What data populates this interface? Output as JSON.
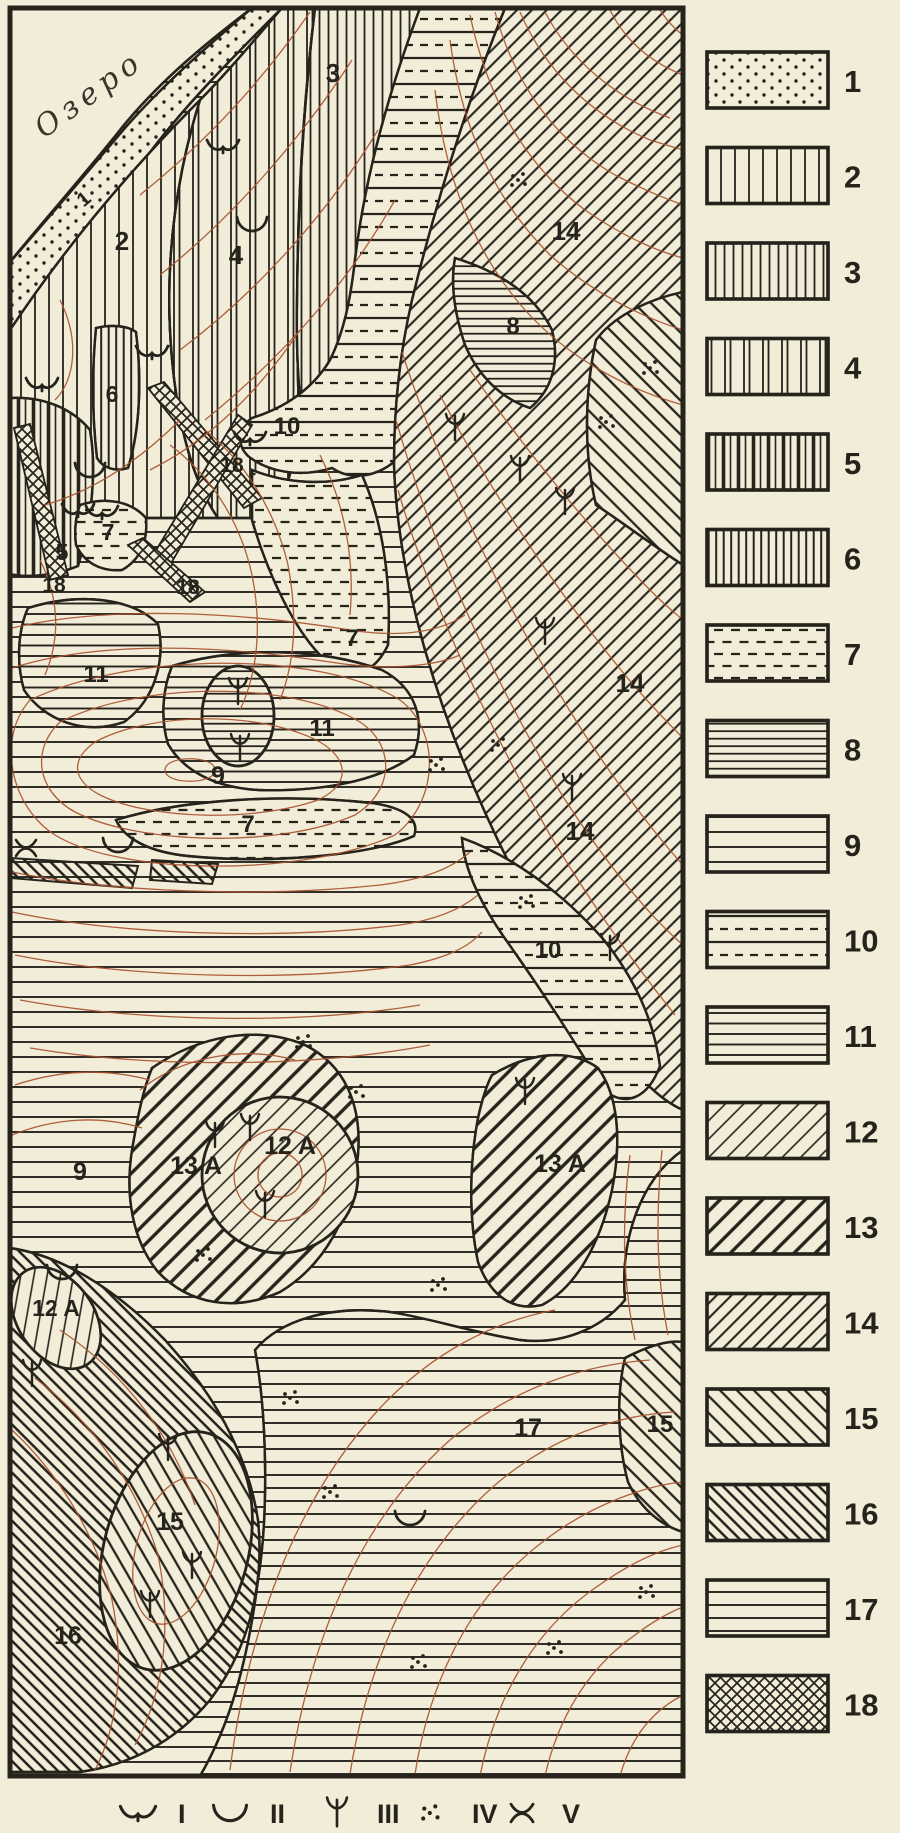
{
  "colors": {
    "paper": "#f2edd8",
    "ink": "#26231c",
    "contour_line": "#a8512f"
  },
  "map": {
    "lake_label": "Озеро",
    "labels": [
      {
        "t": "1",
        "x": 88,
        "y": 204,
        "r": -40,
        "fs": 20
      },
      {
        "t": "2",
        "x": 122,
        "y": 250,
        "fs": 26
      },
      {
        "t": "3",
        "x": 333,
        "y": 82,
        "fs": 26
      },
      {
        "t": "4",
        "x": 236,
        "y": 264,
        "fs": 26
      },
      {
        "t": "14",
        "x": 566,
        "y": 240,
        "fs": 26
      },
      {
        "t": "8",
        "x": 513,
        "y": 334,
        "fs": 24
      },
      {
        "t": "10",
        "x": 287,
        "y": 434,
        "fs": 24
      },
      {
        "t": "6",
        "x": 112,
        "y": 402,
        "fs": 23
      },
      {
        "t": "18",
        "x": 232,
        "y": 472,
        "fs": 21
      },
      {
        "t": "5",
        "x": 62,
        "y": 560,
        "fs": 23
      },
      {
        "t": "7",
        "x": 108,
        "y": 540,
        "fs": 23
      },
      {
        "t": "18",
        "x": 54,
        "y": 592,
        "fs": 21
      },
      {
        "t": "18",
        "x": 188,
        "y": 594,
        "fs": 21
      },
      {
        "t": "7",
        "x": 352,
        "y": 646,
        "fs": 24
      },
      {
        "t": "14",
        "x": 630,
        "y": 692,
        "fs": 26
      },
      {
        "t": "11",
        "x": 96,
        "y": 682,
        "fs": 24
      },
      {
        "t": "11",
        "x": 322,
        "y": 736,
        "fs": 24
      },
      {
        "t": "14",
        "x": 580,
        "y": 840,
        "fs": 26
      },
      {
        "t": "9",
        "x": 218,
        "y": 784,
        "fs": 25
      },
      {
        "t": "7",
        "x": 248,
        "y": 832,
        "fs": 24
      },
      {
        "t": "10",
        "x": 548,
        "y": 958,
        "fs": 24
      },
      {
        "t": "9",
        "x": 80,
        "y": 1180,
        "fs": 25
      },
      {
        "t": "12 A",
        "x": 290,
        "y": 1154,
        "fs": 25
      },
      {
        "t": "13 A",
        "x": 196,
        "y": 1174,
        "fs": 25
      },
      {
        "t": "13 A",
        "x": 560,
        "y": 1172,
        "fs": 25
      },
      {
        "t": "12 A",
        "x": 56,
        "y": 1316,
        "fs": 23
      },
      {
        "t": "15",
        "x": 660,
        "y": 1432,
        "fs": 24
      },
      {
        "t": "17",
        "x": 528,
        "y": 1436,
        "fs": 25
      },
      {
        "t": "15",
        "x": 170,
        "y": 1530,
        "fs": 25
      },
      {
        "t": "16",
        "x": 68,
        "y": 1644,
        "fs": 25
      }
    ],
    "symbols": [
      {
        "t": "I",
        "x": 223,
        "y": 146
      },
      {
        "t": "II",
        "x": 252,
        "y": 224
      },
      {
        "t": "I",
        "x": 152,
        "y": 352
      },
      {
        "t": "I",
        "x": 42,
        "y": 384
      },
      {
        "t": "II",
        "x": 90,
        "y": 470
      },
      {
        "t": "I",
        "x": 250,
        "y": 438
      },
      {
        "t": "I",
        "x": 78,
        "y": 510
      },
      {
        "t": "I",
        "x": 102,
        "y": 512
      },
      {
        "t": "III",
        "x": 238,
        "y": 692
      },
      {
        "t": "III",
        "x": 240,
        "y": 748
      },
      {
        "t": "II",
        "x": 118,
        "y": 845
      },
      {
        "t": "V",
        "x": 26,
        "y": 848
      },
      {
        "t": "III",
        "x": 455,
        "y": 428
      },
      {
        "t": "III",
        "x": 565,
        "y": 502
      },
      {
        "t": "III",
        "x": 520,
        "y": 470
      },
      {
        "t": "III",
        "x": 545,
        "y": 632
      },
      {
        "t": "III",
        "x": 572,
        "y": 788
      },
      {
        "t": "III",
        "x": 610,
        "y": 948
      },
      {
        "t": "IV",
        "x": 520,
        "y": 180
      },
      {
        "t": "IV",
        "x": 652,
        "y": 368
      },
      {
        "t": "IV",
        "x": 608,
        "y": 422
      },
      {
        "t": "IV",
        "x": 500,
        "y": 745
      },
      {
        "t": "IV",
        "x": 438,
        "y": 765
      },
      {
        "t": "IV",
        "x": 528,
        "y": 902
      },
      {
        "t": "IV",
        "x": 305,
        "y": 1042
      },
      {
        "t": "IV",
        "x": 358,
        "y": 1092
      },
      {
        "t": "III",
        "x": 525,
        "y": 1092
      },
      {
        "t": "III",
        "x": 250,
        "y": 1128
      },
      {
        "t": "III",
        "x": 215,
        "y": 1135
      },
      {
        "t": "III",
        "x": 265,
        "y": 1205
      },
      {
        "t": "IV",
        "x": 205,
        "y": 1255
      },
      {
        "t": "IV",
        "x": 440,
        "y": 1285
      },
      {
        "t": "II",
        "x": 62,
        "y": 1272
      },
      {
        "t": "III",
        "x": 32,
        "y": 1374
      },
      {
        "t": "IV",
        "x": 292,
        "y": 1398
      },
      {
        "t": "IV",
        "x": 332,
        "y": 1492
      },
      {
        "t": "III",
        "x": 168,
        "y": 1448
      },
      {
        "t": "III",
        "x": 150,
        "y": 1605
      },
      {
        "t": "III",
        "x": 192,
        "y": 1566
      },
      {
        "t": "II",
        "x": 410,
        "y": 1518
      },
      {
        "t": "IV",
        "x": 420,
        "y": 1662
      },
      {
        "t": "IV",
        "x": 556,
        "y": 1648
      },
      {
        "t": "IV",
        "x": 648,
        "y": 1592
      }
    ]
  },
  "legend": {
    "items": [
      {
        "num": "1",
        "pattern": "dots"
      },
      {
        "num": "2",
        "pattern": "vertical-lines-wide"
      },
      {
        "num": "3",
        "pattern": "vertical-lines-medium"
      },
      {
        "num": "4",
        "pattern": "vertical-lines-paired"
      },
      {
        "num": "5",
        "pattern": "vertical-lines-thick-thin"
      },
      {
        "num": "6",
        "pattern": "vertical-lines-dense"
      },
      {
        "num": "7",
        "pattern": "horizontal-dashes"
      },
      {
        "num": "8",
        "pattern": "horizontal-lines-dense"
      },
      {
        "num": "9",
        "pattern": "horizontal-lines-wide"
      },
      {
        "num": "10",
        "pattern": "horizontal-solid-and-dashed"
      },
      {
        "num": "11",
        "pattern": "horizontal-lines-medium"
      },
      {
        "num": "12",
        "pattern": "diagonal-thin"
      },
      {
        "num": "13",
        "pattern": "diagonal-thick"
      },
      {
        "num": "14",
        "pattern": "diagonal-medium"
      },
      {
        "num": "15",
        "pattern": "back-diagonal-medium"
      },
      {
        "num": "16",
        "pattern": "back-diagonal-dense"
      },
      {
        "num": "17",
        "pattern": "horizontal-lines-sparse"
      },
      {
        "num": "18",
        "pattern": "crosshatch-diamond"
      }
    ]
  },
  "symbol_key": {
    "items": [
      {
        "numeral": "I",
        "symbol": "crescent-notched"
      },
      {
        "numeral": "II",
        "symbol": "crescent"
      },
      {
        "numeral": "III",
        "symbol": "trident"
      },
      {
        "numeral": "IV",
        "symbol": "dot-cluster"
      },
      {
        "numeral": "V",
        "symbol": "double-crescent-cross"
      }
    ]
  }
}
